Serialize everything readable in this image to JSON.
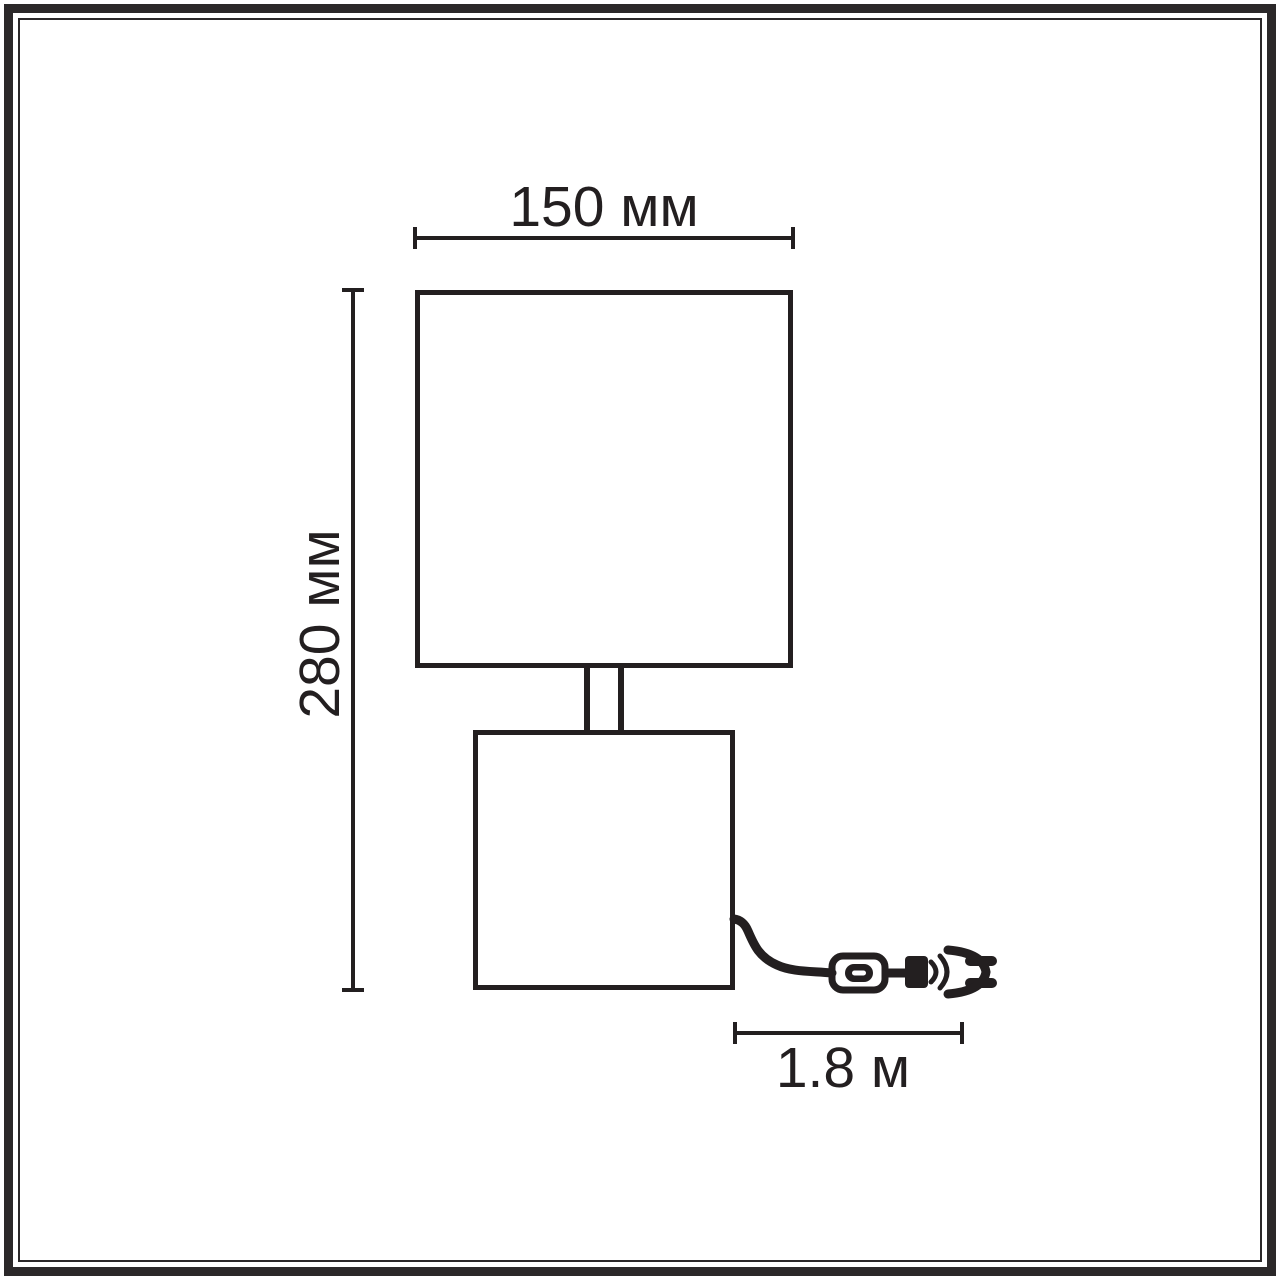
{
  "diagram": {
    "kind": "product-dimension-line-drawing",
    "subject": "table lamp with square shade, stem, square base, power cord with inline switch and plug",
    "ink_color": "#231f20",
    "frame_color": "#2b2829",
    "background_color": "#ffffff",
    "labels": {
      "shade_width": "150 мм",
      "total_height": "280 мм",
      "cable_length": "1.8 м"
    },
    "measurements": [
      {
        "name": "shade width",
        "value": 150,
        "unit": "мм"
      },
      {
        "name": "total height",
        "value": 280,
        "unit": "мм"
      },
      {
        "name": "cable length",
        "value": 1.8,
        "unit": "м"
      }
    ],
    "icons": [
      "lamp-shade-icon",
      "lamp-stem-icon",
      "lamp-base-icon",
      "power-cable-icon",
      "inline-switch-icon",
      "power-plug-icon"
    ]
  }
}
